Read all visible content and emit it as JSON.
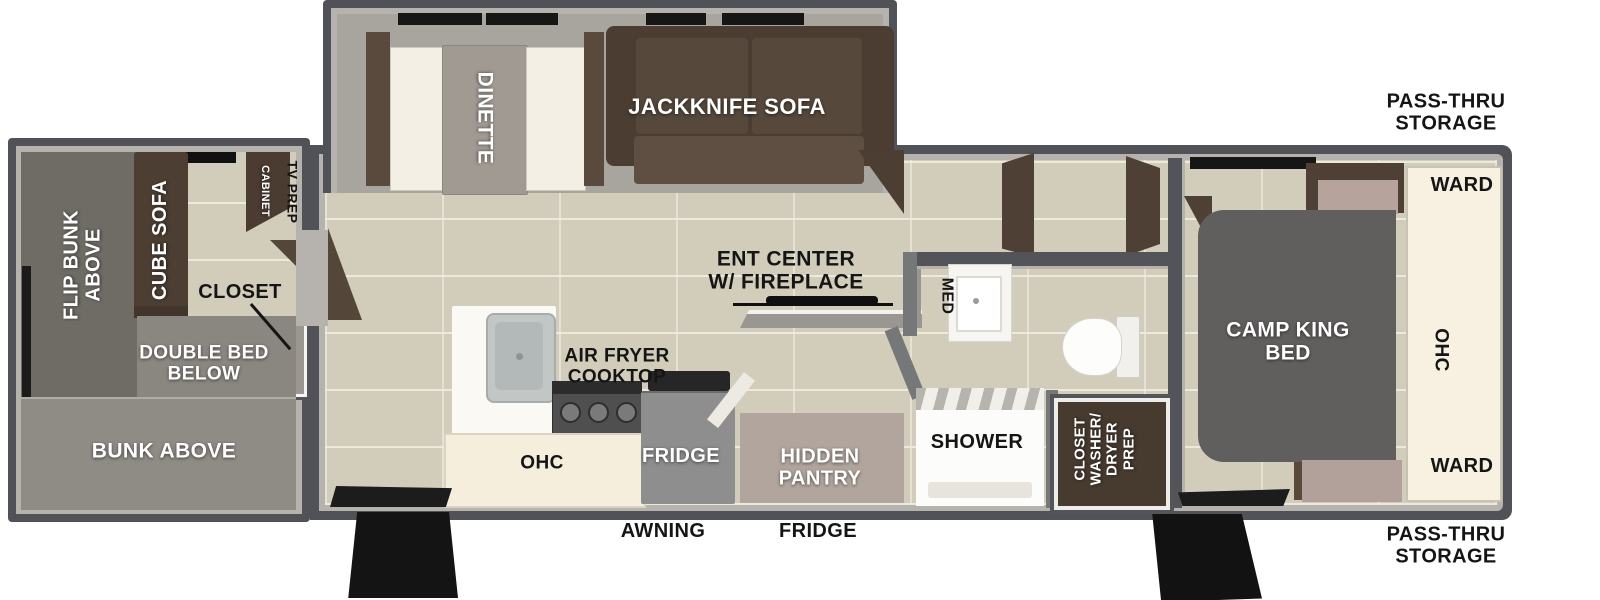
{
  "floorplan": {
    "title": "travel-trailer-floorplan",
    "colors": {
      "exterior_wall": "#515257",
      "wall_highlight": "#b6b3ae",
      "tile_floor": "#d2ccba",
      "slide_floor": "#a8a59e",
      "bunkroom_floor": "#8d8a84",
      "sofa_brown": "#4b3d32",
      "cabinet_cream": "#f5eedd",
      "bed_gray": "#615f5e",
      "accent_mauve": "#b2a19b",
      "fixture_white": "#fbf9f3",
      "step_black": "#141414",
      "label_black": "#151515",
      "label_white": "#ffffff"
    },
    "labels": [
      {
        "name": "label-dinette",
        "lines": [
          "DINETTE"
        ],
        "color": "white",
        "rot": 90,
        "x": 484,
        "y": 118,
        "size": 21
      },
      {
        "name": "label-jackknife-sofa",
        "lines": [
          "JACKKNIFE SOFA"
        ],
        "color": "white",
        "rot": 0,
        "x": 727,
        "y": 107,
        "size": 22
      },
      {
        "name": "label-pass-thru-storage-top",
        "lines": [
          "PASS-THRU",
          "STORAGE"
        ],
        "color": "black",
        "rot": 0,
        "x": 1446,
        "y": 113,
        "size": 20
      },
      {
        "name": "label-ward-top",
        "lines": [
          "WARD"
        ],
        "color": "black",
        "rot": 0,
        "x": 1462,
        "y": 186,
        "size": 20
      },
      {
        "name": "label-ohc-bedroom",
        "lines": [
          "OHC"
        ],
        "color": "black",
        "rot": 90,
        "x": 1440,
        "y": 350,
        "size": 19
      },
      {
        "name": "label-ward-bottom",
        "lines": [
          "WARD"
        ],
        "color": "black",
        "rot": 0,
        "x": 1462,
        "y": 467,
        "size": 20
      },
      {
        "name": "label-camp-king-bed",
        "lines": [
          "CAMP KING",
          "BED"
        ],
        "color": "white",
        "rot": 0,
        "x": 1288,
        "y": 342,
        "size": 21
      },
      {
        "name": "label-ent-center",
        "lines": [
          "ENT CENTER",
          "W/ FIREPLACE"
        ],
        "color": "black",
        "rot": 0,
        "x": 786,
        "y": 271,
        "size": 21
      },
      {
        "name": "label-med",
        "lines": [
          "MED"
        ],
        "color": "black",
        "rot": 90,
        "x": 947,
        "y": 296,
        "size": 16
      },
      {
        "name": "label-shower",
        "lines": [
          "SHOWER"
        ],
        "color": "black",
        "rot": 0,
        "x": 977,
        "y": 443,
        "size": 20
      },
      {
        "name": "label-closet-washer-dryer",
        "lines": [
          "CLOSET",
          "WASHER/",
          "DRYER",
          "PREP"
        ],
        "color": "white",
        "rot": -90,
        "x": 1105,
        "y": 449,
        "size": 15
      },
      {
        "name": "label-air-fryer-cooktop",
        "lines": [
          "AIR FRYER",
          "COOKTOP"
        ],
        "color": "black",
        "rot": 0,
        "x": 617,
        "y": 367,
        "size": 19
      },
      {
        "name": "label-ohc-kitchen",
        "lines": [
          "OHC"
        ],
        "color": "black",
        "rot": 0,
        "x": 542,
        "y": 464,
        "size": 19
      },
      {
        "name": "label-fridge-appliance",
        "lines": [
          "FRIDGE"
        ],
        "color": "white",
        "rot": 0,
        "x": 681,
        "y": 457,
        "size": 20
      },
      {
        "name": "label-hidden-pantry",
        "lines": [
          "HIDDEN",
          "PANTRY"
        ],
        "color": "white",
        "rot": 0,
        "x": 820,
        "y": 468,
        "size": 20
      },
      {
        "name": "label-awning",
        "lines": [
          "AWNING"
        ],
        "color": "black",
        "rot": 0,
        "x": 663,
        "y": 532,
        "size": 20
      },
      {
        "name": "label-fridge-exterior",
        "lines": [
          "FRIDGE"
        ],
        "color": "black",
        "rot": 0,
        "x": 818,
        "y": 532,
        "size": 20
      },
      {
        "name": "label-pass-thru-storage-bottom",
        "lines": [
          "PASS-THRU",
          "STORAGE"
        ],
        "color": "black",
        "rot": 0,
        "x": 1446,
        "y": 546,
        "size": 20
      },
      {
        "name": "label-flip-bunk-above",
        "lines": [
          "FLIP BUNK",
          "ABOVE"
        ],
        "color": "white",
        "rot": -90,
        "x": 83,
        "y": 265,
        "size": 20
      },
      {
        "name": "label-cube-sofa",
        "lines": [
          "CUBE SOFA"
        ],
        "color": "white",
        "rot": -90,
        "x": 161,
        "y": 240,
        "size": 20
      },
      {
        "name": "label-tv-prep",
        "lines": [
          "TV PREP"
        ],
        "color": "black",
        "rot": 90,
        "x": 292,
        "y": 192,
        "size": 14
      },
      {
        "name": "label-cabinet",
        "lines": [
          "CABINET"
        ],
        "color": "white",
        "rot": 90,
        "x": 264,
        "y": 191,
        "size": 11
      },
      {
        "name": "label-closet",
        "lines": [
          "CLOSET"
        ],
        "color": "black",
        "rot": 0,
        "x": 240,
        "y": 293,
        "size": 20
      },
      {
        "name": "label-double-bed-below",
        "lines": [
          "DOUBLE BED",
          "BELOW"
        ],
        "color": "white",
        "rot": 0,
        "x": 204,
        "y": 364,
        "size": 19
      },
      {
        "name": "label-bunk-above",
        "lines": [
          "BUNK ABOVE"
        ],
        "color": "white",
        "rot": 0,
        "x": 164,
        "y": 452,
        "size": 21
      }
    ]
  }
}
